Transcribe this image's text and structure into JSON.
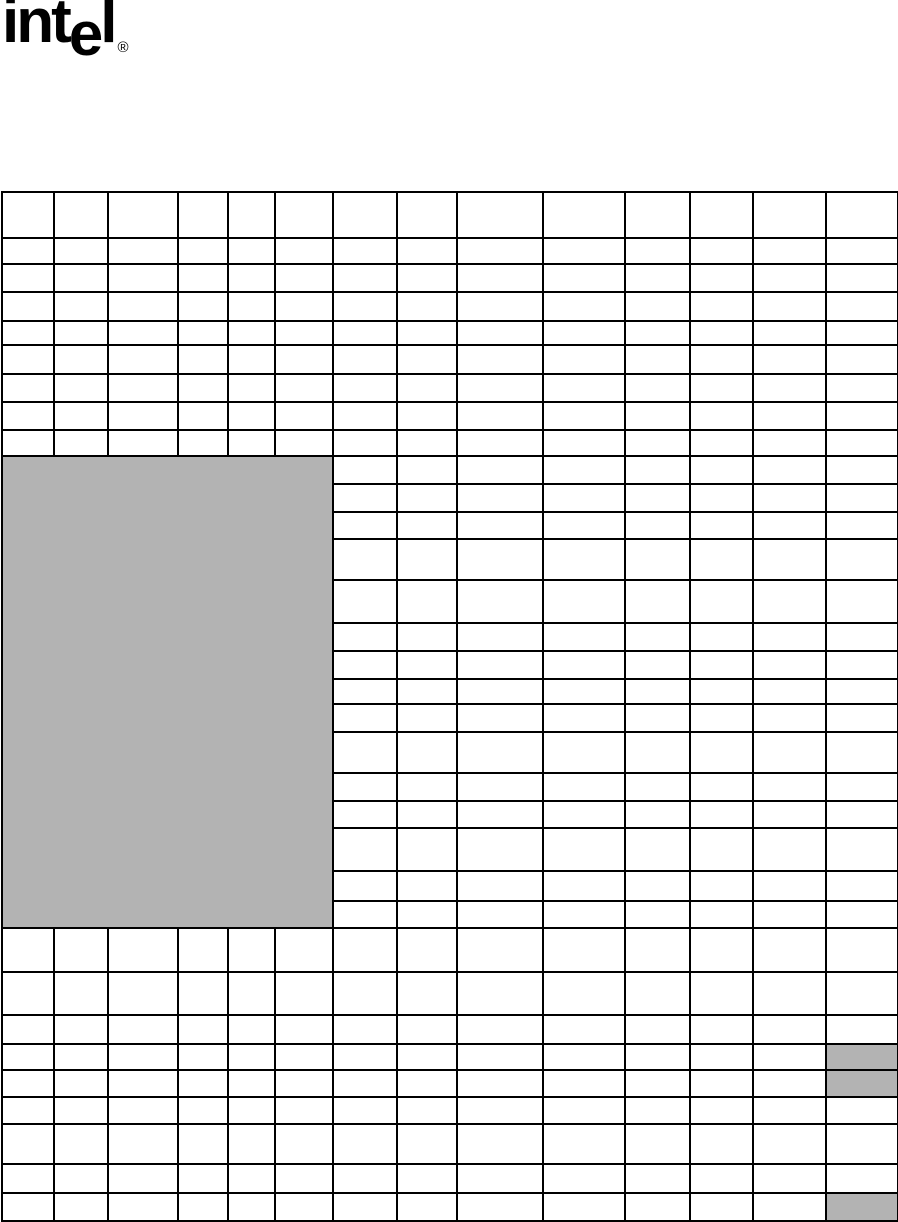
{
  "page": {
    "background_color": "#ffffff",
    "width_px": 898,
    "height_px": 1222
  },
  "logo": {
    "brand": "intel",
    "text_pre": "int",
    "text_drop": "e",
    "text_post": "l",
    "registered_mark": "®",
    "color": "#000000"
  },
  "table": {
    "columns": 14,
    "rows": 33,
    "column_widths_px": [
      52,
      54,
      70,
      50,
      47,
      58,
      64,
      60,
      86,
      82,
      65,
      63,
      73,
      72
    ],
    "row_heights_px": [
      46,
      26,
      28,
      29,
      24,
      29,
      28,
      28,
      26,
      28,
      28,
      27,
      41,
      43,
      28,
      28,
      25,
      28,
      41,
      28,
      27,
      43,
      30,
      27,
      44,
      43,
      29,
      26,
      27,
      27,
      40,
      29,
      28
    ],
    "border_color": "#000000",
    "border_width_px": 2,
    "shade_fill": "#b3b3b3",
    "cell_text": "",
    "merged_shaded_block": {
      "start_row": 9,
      "row_span": 15,
      "start_col": 0,
      "col_span": 6
    },
    "shaded_cells": [
      {
        "row": 27,
        "col": 13
      },
      {
        "row": 28,
        "col": 13
      },
      {
        "row": 32,
        "col": 13
      }
    ]
  }
}
